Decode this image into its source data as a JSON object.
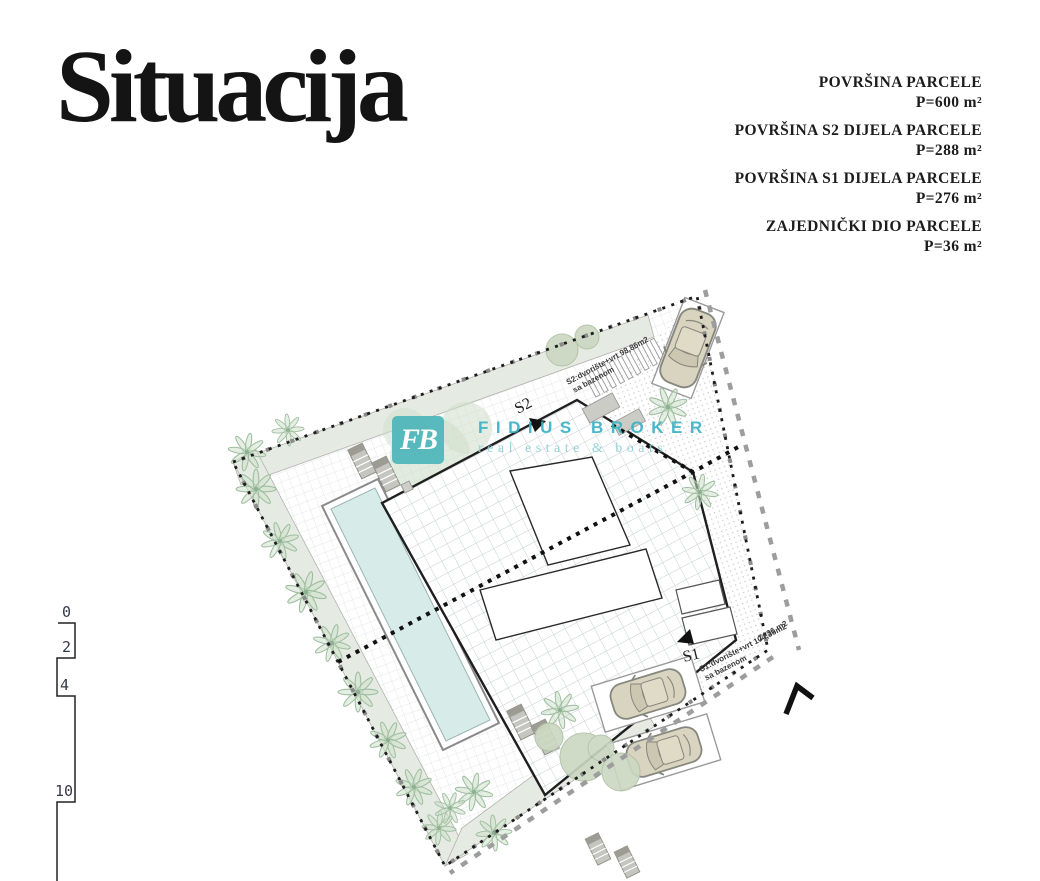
{
  "title": "Situacija",
  "legend": {
    "areas": [
      {
        "label": "POVRŠINA PARCELE",
        "value": "P=600 m²"
      },
      {
        "label": "POVRŠINA S2 DIJELA PARCELE",
        "value": "P=288 m²"
      },
      {
        "label": "POVRŠINA S1 DIJELA PARCELE",
        "value": "P=276 m²"
      },
      {
        "label": "ZAJEDNIČKI DIO PARCELE",
        "value": "P=36 m²"
      }
    ]
  },
  "plan": {
    "s2_label": "S2",
    "s1_label": "S1",
    "s2_annotation_line1": "S2:dvorište+vrt 98,86m2",
    "s2_annotation_line2": "sa bazenom",
    "s1_annotation_line1": "S1:dvorište+vrt 104,36m2",
    "s1_annotation_line2": "sa bazenom",
    "common_area_label": "Z=36 m2"
  },
  "scale_bar": {
    "labels": [
      "0",
      "2",
      "4",
      "10"
    ]
  },
  "watermark": {
    "logo_text": "FB",
    "name": "FIDIUS BROKER",
    "tagline": "real estate & boats"
  },
  "colors": {
    "brand_teal": "#3cb2c6",
    "logo_bg": "#4db6ba",
    "pool_water": "#d7ebe9",
    "greenery": "#cfe0cb",
    "paving_grid": "#d9dde0",
    "boundary_black": "#1c1c1c",
    "boundary_gray": "#9d9d9d"
  }
}
